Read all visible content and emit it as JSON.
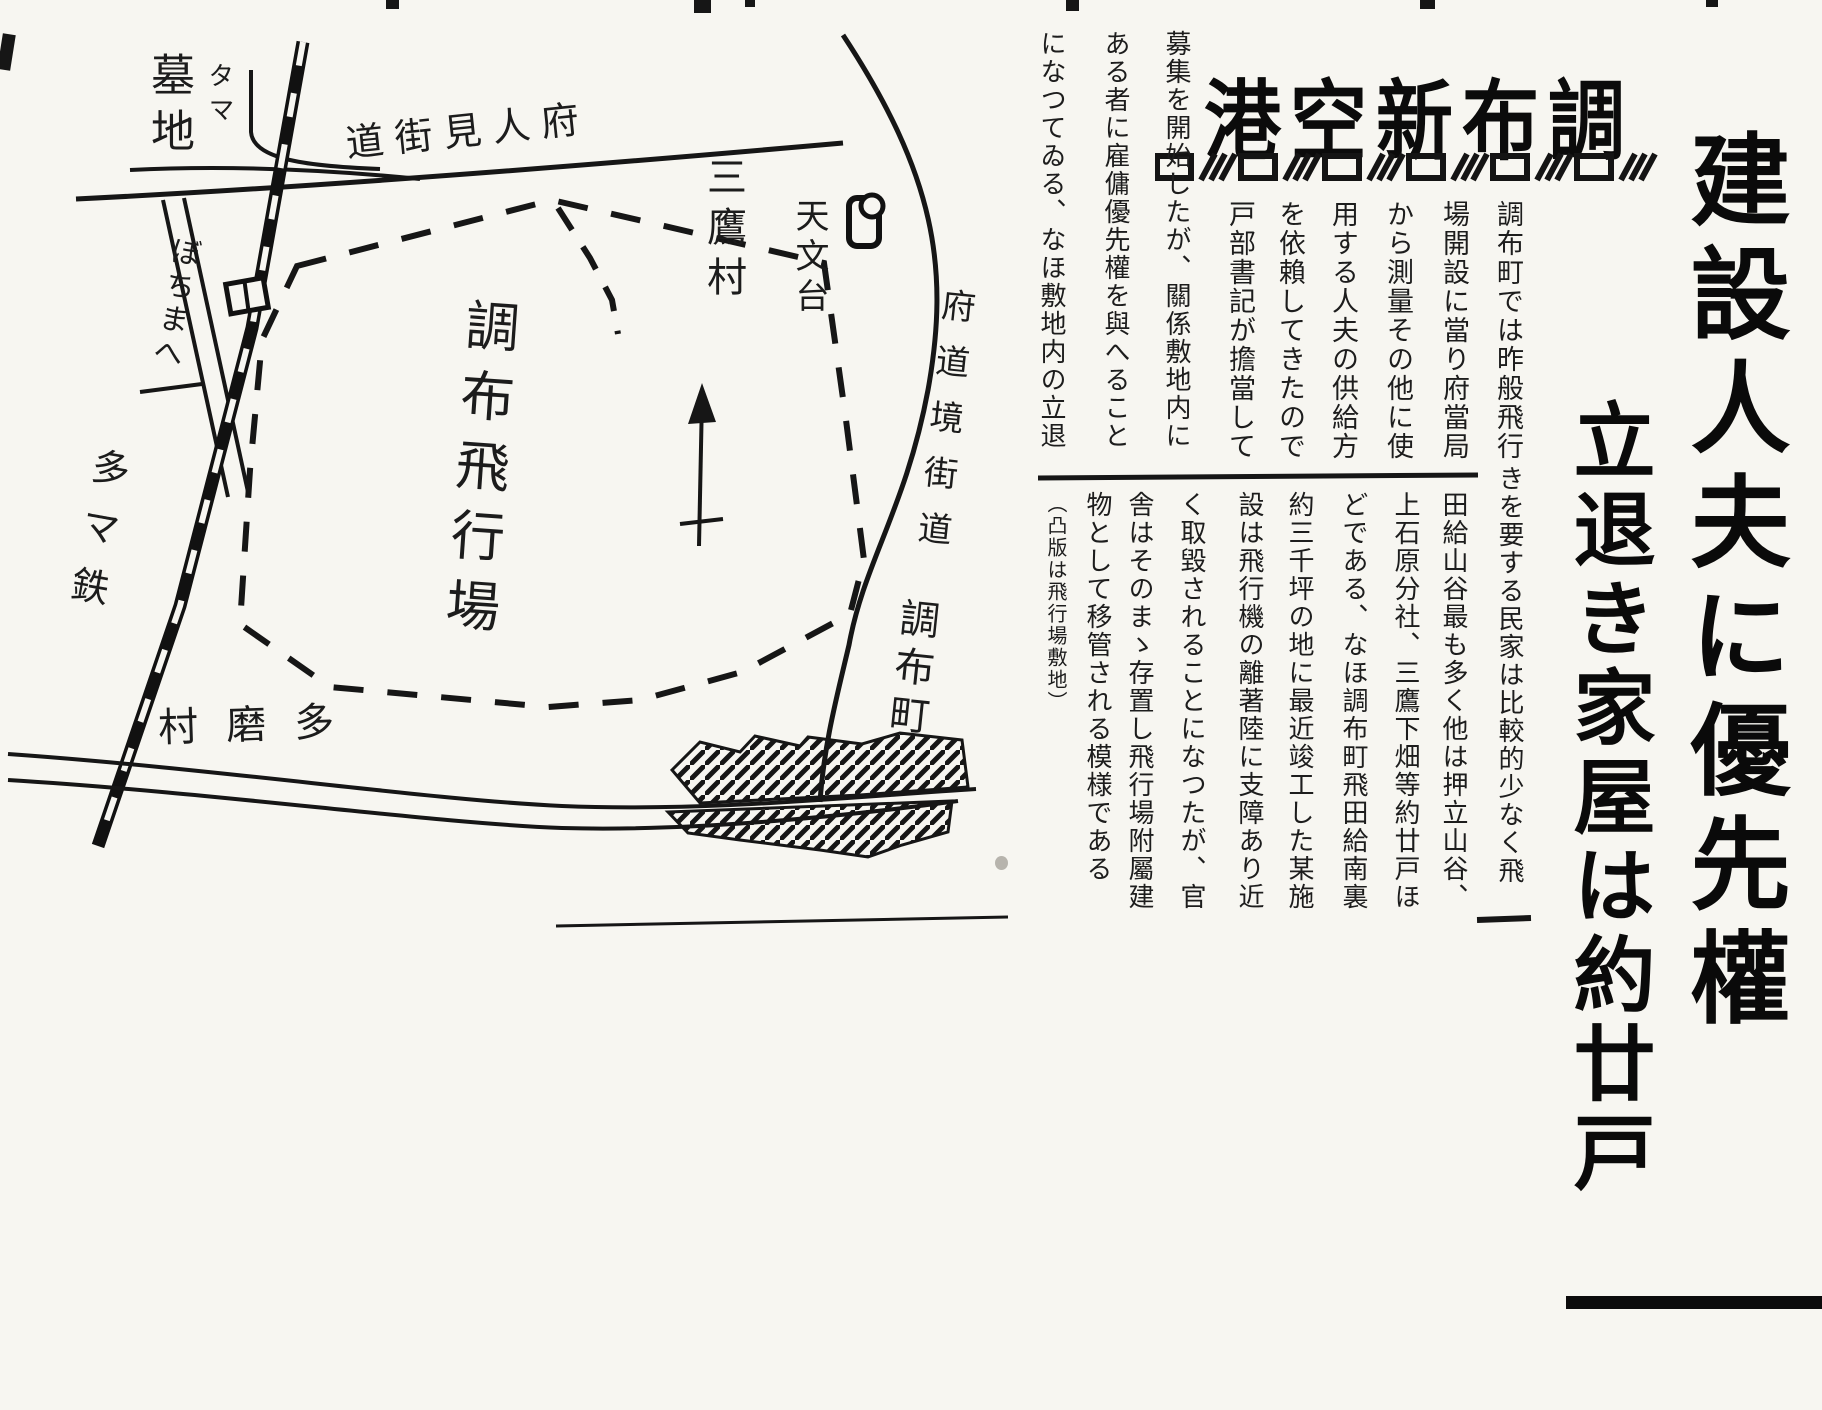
{
  "masthead": {
    "title_display": "港空新布調",
    "title_reading": "調布新空港"
  },
  "headlines": {
    "main_vertical": "建設人夫に優先權",
    "sub_vertical": "立退き家屋は約廿戸"
  },
  "article": {
    "deck1_columns": [
      "調布町では昨般飛行",
      "場開設に當り府當局",
      "から測量その他に使",
      "用する人夫の供給方",
      "を依賴してきたので",
      "戸部書記が擔當して"
    ],
    "deck1_left_columns": [
      "募集を開始したが、關係敷地内に",
      "ある者に雇傭優先權を與へること",
      "になつてゐる、なほ敷地内の立退"
    ],
    "deck2_columns": [
      "きを要する民家は比較的少なく飛",
      "田給山谷最も多く他は押立山谷、",
      "上石原分社、三鷹下畑等約廿戸ほ",
      "どである、なほ調布町飛田給南裏",
      "約三千坪の地に最近竣工した某施",
      "設は飛行機の離著陸に支障あり近",
      "く取毀されることになつたが、官",
      "舎はそのまゝ存置し飛行場附屬建",
      "物として移管される模様である",
      "（凸版は飛行場敷地）"
    ]
  },
  "map": {
    "labels": {
      "cemetery_kana": "タマ",
      "cemetery": "墓地",
      "station": "ぼちまへ",
      "railway": "多マ鉄",
      "village_sw_display": "村磨多",
      "hitomi_road_display": "道街見人府",
      "mitaka_village": "三鷹村",
      "observatory": "天文台",
      "airfield": "調布飛行場",
      "sakai_road": "府道境街道",
      "chofu_town": "調布町"
    },
    "icons": {
      "station_icon": "railway-station-box",
      "observatory_icon": "observatory-dome",
      "north_arrow_icon": "survey-north-arrow"
    }
  },
  "colors": {
    "paper": "#f7f6f1",
    "ink": "#161616"
  }
}
